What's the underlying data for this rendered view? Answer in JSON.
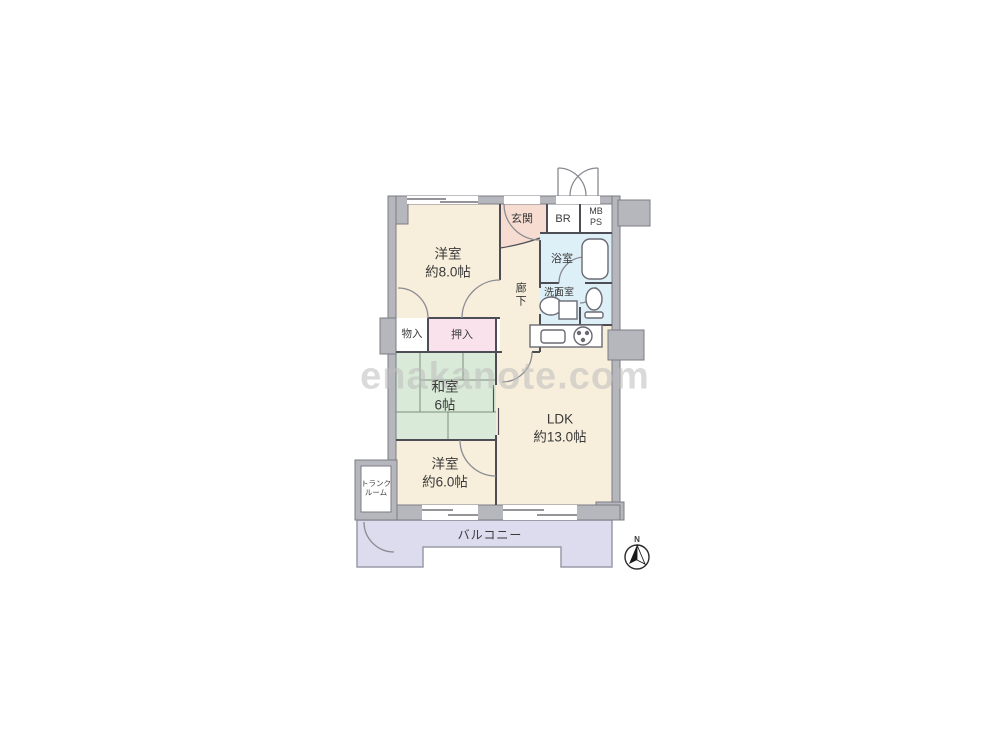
{
  "watermark_text": "enakanote.com",
  "compass": {
    "north": "N"
  },
  "rooms": {
    "western8": {
      "name": "洋室",
      "size": "約8.0帖"
    },
    "entrance": {
      "name": "玄関"
    },
    "corridor": {
      "name": "廊下"
    },
    "br": {
      "name": "BR"
    },
    "meterbox": {
      "line1": "MB",
      "line2": "PS"
    },
    "bath": {
      "name": "浴室"
    },
    "washroom": {
      "name": "洗面室"
    },
    "storage": {
      "name": "物入"
    },
    "closet": {
      "name": "押入"
    },
    "japanese6": {
      "name": "和室",
      "size": "6帖"
    },
    "ldk": {
      "name": "LDK",
      "size": "約13.0帖"
    },
    "western6": {
      "name": "洋室",
      "size": "約6.0帖"
    },
    "trunk": {
      "line1": "トランク",
      "line2": "ルーム"
    },
    "balcony": {
      "name": "バルコニー"
    }
  },
  "colors": {
    "room-cream": "#f7eedb",
    "room-entrance": "#f7ddd1",
    "room-closet": "#f9e2ec",
    "room-tatami": "#d9ebd8",
    "room-water": "#def0f7",
    "room-balcony": "#dcdcee",
    "wall-fill": "#b6b6bd",
    "wall-line": "#7c7c85",
    "thin-line": "#4d4d55",
    "fixture-line": "#6a6a73",
    "label-color": "#3a3a3a",
    "watermark-color": "#bdbdbd"
  }
}
